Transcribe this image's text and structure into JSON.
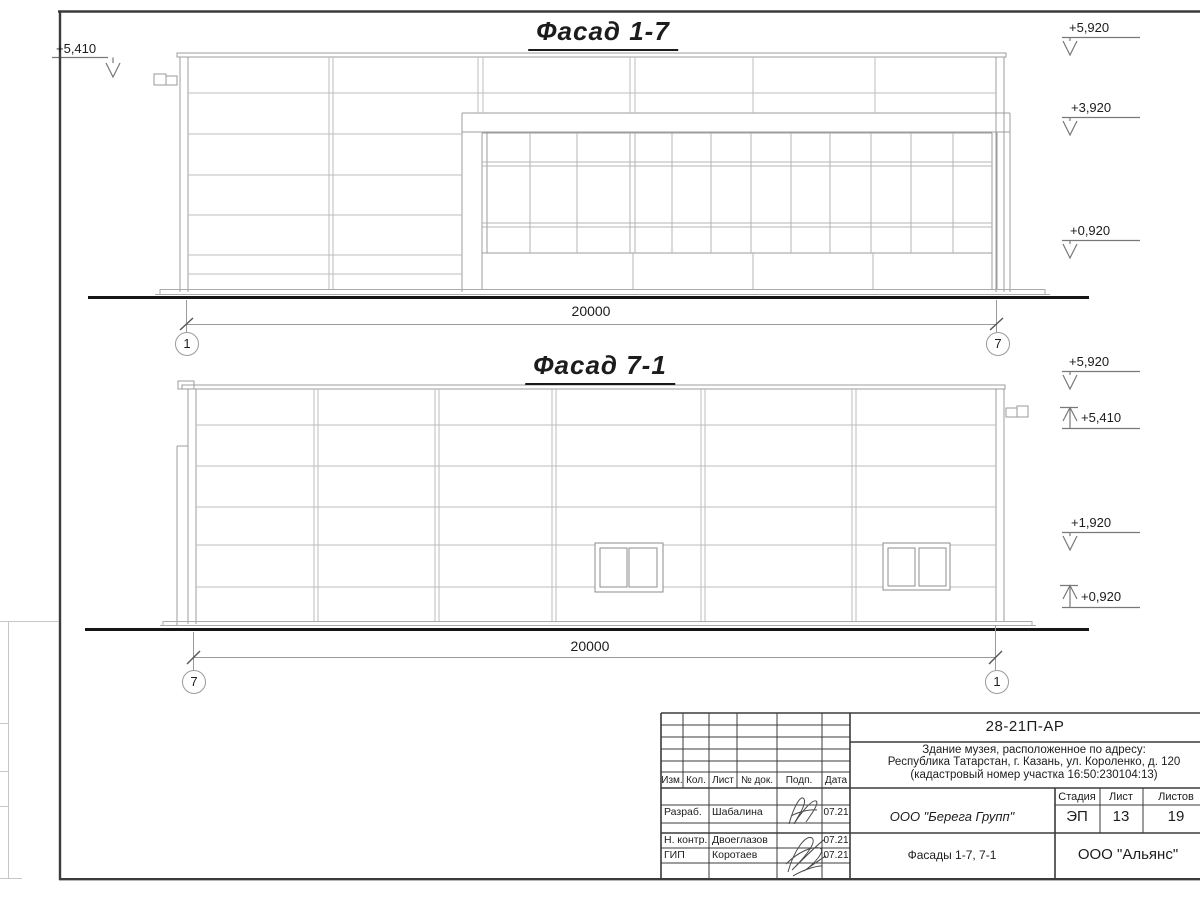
{
  "sheet": {
    "facade_top": {
      "title": "Фасад 1-7",
      "dimension": "20000",
      "grid_left": "1",
      "grid_right": "7",
      "elev_left": "+5,410",
      "elev_right": [
        "+5,920",
        "+3,920",
        "+0,920"
      ]
    },
    "facade_bottom": {
      "title": "Фасад 7-1",
      "dimension": "20000",
      "grid_left": "7",
      "grid_right": "1",
      "elev_right": [
        "+5,920",
        "+5,410",
        "+1,920",
        "+0,920"
      ]
    }
  },
  "title_block": {
    "doc_number": "28-21П-АР",
    "address_line1": "Здание музея, расположенное по адресу:",
    "address_line2": "Республика Татарстан, г. Казань, ул. Короленко, д. 120",
    "address_line3": "(кадастровый номер участка 16:50:230104:13)",
    "col_izm": "Изм.",
    "col_kol": "Кол.",
    "col_list": "Лист",
    "col_doc": "№ док.",
    "col_podp": "Подп.",
    "col_data": "Дата",
    "rows": [
      {
        "role": "Разраб.",
        "name": "Шабалина",
        "date": "07.21"
      },
      {
        "role": "Н. контр.",
        "name": "Двоеглазов",
        "date": "07.21"
      },
      {
        "role": "ГИП",
        "name": "Коротаев",
        "date": "07.21"
      }
    ],
    "company": "ООО \"Берега Групп\"",
    "sheet_title": "Фасады 1-7, 7-1",
    "stage_label": "Стадия",
    "list_label": "Лист",
    "listov_label": "Листов",
    "stage": "ЭП",
    "sheet_no": "13",
    "sheet_total": "19",
    "org": "ООО \"Альянс\""
  }
}
